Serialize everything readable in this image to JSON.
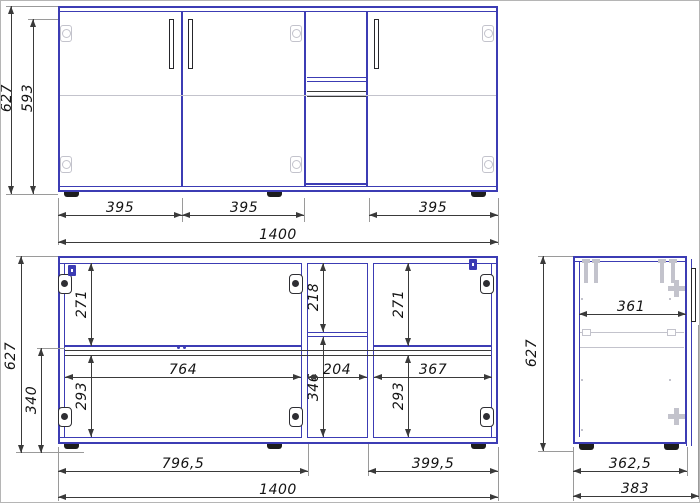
{
  "drawing_type": "cabinet technical drawing",
  "front_view": {
    "overall_height": "627",
    "body_height": "593",
    "door_widths": [
      "395",
      "395",
      "395"
    ],
    "overall_width": "1400"
  },
  "open_view": {
    "overall_height": "627",
    "base_height": "340",
    "left_upper_height": "271",
    "left_lower_height": "293",
    "left_inner_width": "764",
    "middle_upper_height": "218",
    "middle_lower_height": "346",
    "middle_inner_width": "204",
    "right_upper_height": "271",
    "right_lower_height": "293",
    "right_inner_width": "367",
    "left_section_width": "796,5",
    "right_section_width": "399,5",
    "overall_width": "1400"
  },
  "side_view": {
    "overall_height": "627",
    "inner_depth": "361",
    "body_depth": "362,5",
    "overall_depth": "383"
  },
  "colors": {
    "outline_blue": "#3c3cb4",
    "dimension_line": "#3a3a3a",
    "hardware_light": "#c3c3cc",
    "hardware_dark": "#2e2e33"
  }
}
